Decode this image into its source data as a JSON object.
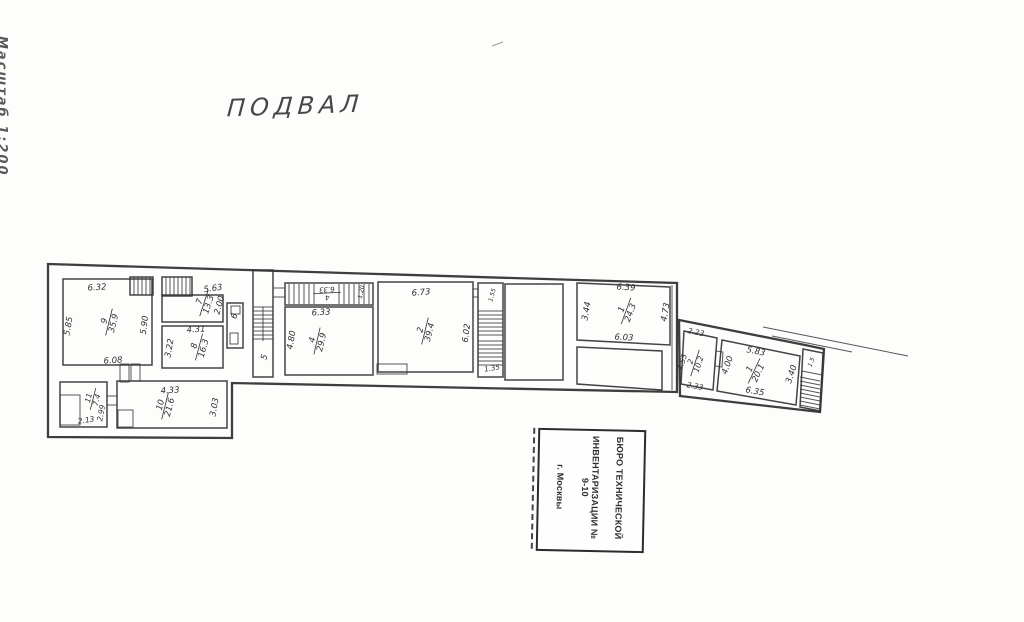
{
  "page": {
    "scale_note": "Масштаб 1:200",
    "title": "ПОДВАЛ"
  },
  "stamp": {
    "line1": "БЮРО ТЕХНИЧЕСКОЙ",
    "line2": "ИНВЕНТАРИЗАЦИИ № 9-10",
    "line3": "г. Москвы"
  },
  "colors": {
    "ink": "#2f2f2f",
    "paper": "#fdfdfc"
  },
  "plan": {
    "labels": [
      {
        "text": "6.32",
        "x": 97,
        "y": 287,
        "rot": -4
      },
      {
        "text": "5.85",
        "x": 68,
        "y": 326,
        "rot": -80
      },
      {
        "text": "5.90",
        "x": 144,
        "y": 325,
        "rot": -83
      },
      {
        "text": "6.08",
        "x": 113,
        "y": 360,
        "rot": -4
      },
      {
        "text": "5.63",
        "x": 213,
        "y": 288,
        "rot": -8
      },
      {
        "text": "2.00",
        "x": 219,
        "y": 305,
        "rot": -75
      },
      {
        "text": "6",
        "x": 234,
        "y": 316,
        "rot": -70
      },
      {
        "text": "4.31",
        "x": 196,
        "y": 329,
        "rot": -4
      },
      {
        "text": "3.22",
        "x": 169,
        "y": 348,
        "rot": -80
      },
      {
        "text": "5",
        "x": 264,
        "y": 357,
        "rot": -75
      },
      {
        "text": "4.80",
        "x": 291,
        "y": 340,
        "rot": -80
      },
      {
        "text": "6.33",
        "x": 321,
        "y": 312,
        "rot": -3
      },
      {
        "text": "1.20",
        "x": 361,
        "y": 292,
        "rot": -80,
        "size": 6
      },
      {
        "text": "6.73",
        "x": 421,
        "y": 292,
        "rot": -5
      },
      {
        "text": "6.02",
        "x": 466,
        "y": 333,
        "rot": -83
      },
      {
        "text": "1.55",
        "x": 492,
        "y": 295,
        "rot": -75,
        "size": 6
      },
      {
        "text": "1.35",
        "x": 492,
        "y": 368,
        "rot": -10,
        "size": 7
      },
      {
        "text": "6.39",
        "x": 626,
        "y": 287,
        "rot": 3
      },
      {
        "text": "3.44",
        "x": 586,
        "y": 311,
        "rot": -80
      },
      {
        "text": "6.03",
        "x": 624,
        "y": 337,
        "rot": 3
      },
      {
        "text": "4.73",
        "x": 665,
        "y": 312,
        "rot": -80
      },
      {
        "text": "2.13",
        "x": 86,
        "y": 420,
        "rot": -8,
        "size": 7.5
      },
      {
        "text": "2.99",
        "x": 101,
        "y": 413,
        "rot": -80,
        "size": 7.5
      },
      {
        "text": "4.33",
        "x": 170,
        "y": 390,
        "rot": -3
      },
      {
        "text": "3.03",
        "x": 214,
        "y": 407,
        "rot": -80
      },
      {
        "text": "2.23",
        "x": 696,
        "y": 332,
        "rot": 12,
        "size": 7.5
      },
      {
        "text": "4.53",
        "x": 682,
        "y": 362,
        "rot": -72,
        "size": 7.5
      },
      {
        "text": "2.33",
        "x": 695,
        "y": 386,
        "rot": 10,
        "size": 7.5
      },
      {
        "text": "5.83",
        "x": 756,
        "y": 351,
        "rot": 11
      },
      {
        "text": "4.00",
        "x": 727,
        "y": 365,
        "rot": -70
      },
      {
        "text": "6.35",
        "x": 755,
        "y": 391,
        "rot": 10
      },
      {
        "text": "3.40",
        "x": 791,
        "y": 374,
        "rot": -72
      },
      {
        "text": "1.5",
        "x": 811,
        "y": 362,
        "rot": -70,
        "size": 6
      },
      {
        "num": "9",
        "den": "35.9",
        "x": 109,
        "y": 322,
        "rot": -76
      },
      {
        "num": "7",
        "den": "13.3",
        "x": 204,
        "y": 303,
        "rot": -72
      },
      {
        "num": "8",
        "den": "16.3",
        "x": 199,
        "y": 347,
        "rot": -75
      },
      {
        "num": "11",
        "den": "7.4",
        "x": 93,
        "y": 399,
        "rot": -76,
        "size": 7.5
      },
      {
        "num": "10",
        "den": "21.6",
        "x": 165,
        "y": 406,
        "rot": -76
      },
      {
        "num": "4",
        "den": "29.9",
        "x": 317,
        "y": 341,
        "rot": -77
      },
      {
        "num": "4",
        "den": "6.33",
        "x": 327,
        "y": 293,
        "rot": 177,
        "size": 7
      },
      {
        "num": "2",
        "den": "39.4",
        "x": 425,
        "y": 331,
        "rot": -76
      },
      {
        "num": "1",
        "den": "24.3",
        "x": 626,
        "y": 311,
        "rot": -70
      },
      {
        "num": "2",
        "den": "10.2",
        "x": 695,
        "y": 363,
        "rot": -72,
        "size": 7.5
      },
      {
        "num": "1",
        "den": "20.1",
        "x": 754,
        "y": 371,
        "rot": -65
      }
    ]
  }
}
